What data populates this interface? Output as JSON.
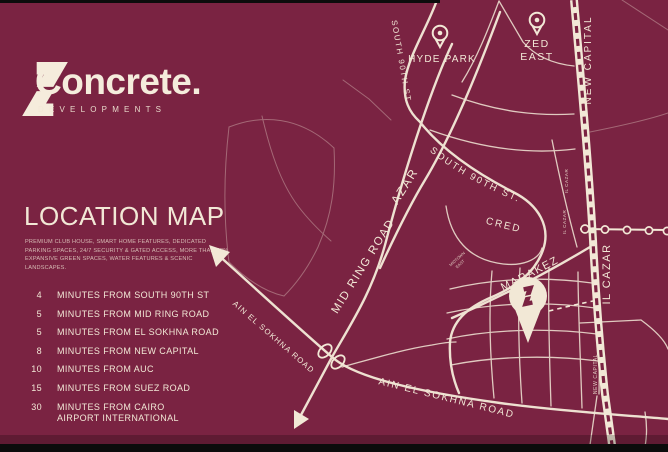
{
  "colors": {
    "background": "#7a2342",
    "cream": "#f2e8d6",
    "black_bar": "#0c0c0c"
  },
  "brand": {
    "name": "Concrete.",
    "subtitle": "DEVELOPMENTS"
  },
  "panel": {
    "title": "LOCATION MAP",
    "description_lines": [
      "PREMIUM CLUB HOUSE, SMART HOME FEATURES, DEDICATED",
      "PARKING SPACES, 24/7 SECURITY & GATED ACCESS, MORE THAN 82%",
      "EXPANSIVE GREEN SPACES, WATER FEATURES & SCENIC LANDSCAPES."
    ],
    "distances": [
      {
        "minutes": "4",
        "label": "MINUTES FROM SOUTH 90TH ST"
      },
      {
        "minutes": "5",
        "label": "MINUTES FROM MID RING ROAD"
      },
      {
        "minutes": "5",
        "label": "MINUTES FROM EL SOKHNA ROAD"
      },
      {
        "minutes": "8",
        "label": "MINUTES FROM NEW CAPITAL"
      },
      {
        "minutes": "10",
        "label": "MINUTES FROM AUC"
      },
      {
        "minutes": "15",
        "label": "MINUTES FROM SUEZ ROAD"
      },
      {
        "minutes": "30",
        "label": "MINUTES FROM CAIRO\nAIRPORT INTERNATIONAL"
      }
    ]
  },
  "map": {
    "labels": {
      "south_90th_vertical": "SOUTH 90TH ST.",
      "hyde_park": "HYDE PARK",
      "zed_line1": "ZED",
      "zed_line2": "EAST",
      "new_capital_top": "NEW CAPITAL",
      "new_capital_small": "NEW CAPITAL",
      "azar": "AZAR",
      "mid_ring_road": "MID RING ROAD",
      "south_90th_curve": "SOUTH 90TH ST.",
      "cred": "CRED",
      "marakez": "MARAKEZ",
      "il_cazar_large": "IL CAZAR",
      "il_cazar_small_1": "IL CAZAR",
      "il_cazar_small_2": "IL CAZAR",
      "midtown_line1": "MIDTOWN",
      "midtown_line2": "EAST",
      "ain_sokhna_upper": "AIN EL SOKHNA ROAD",
      "ain_sokhna_lower": "AIN EL SOKHNA ROAD"
    }
  }
}
